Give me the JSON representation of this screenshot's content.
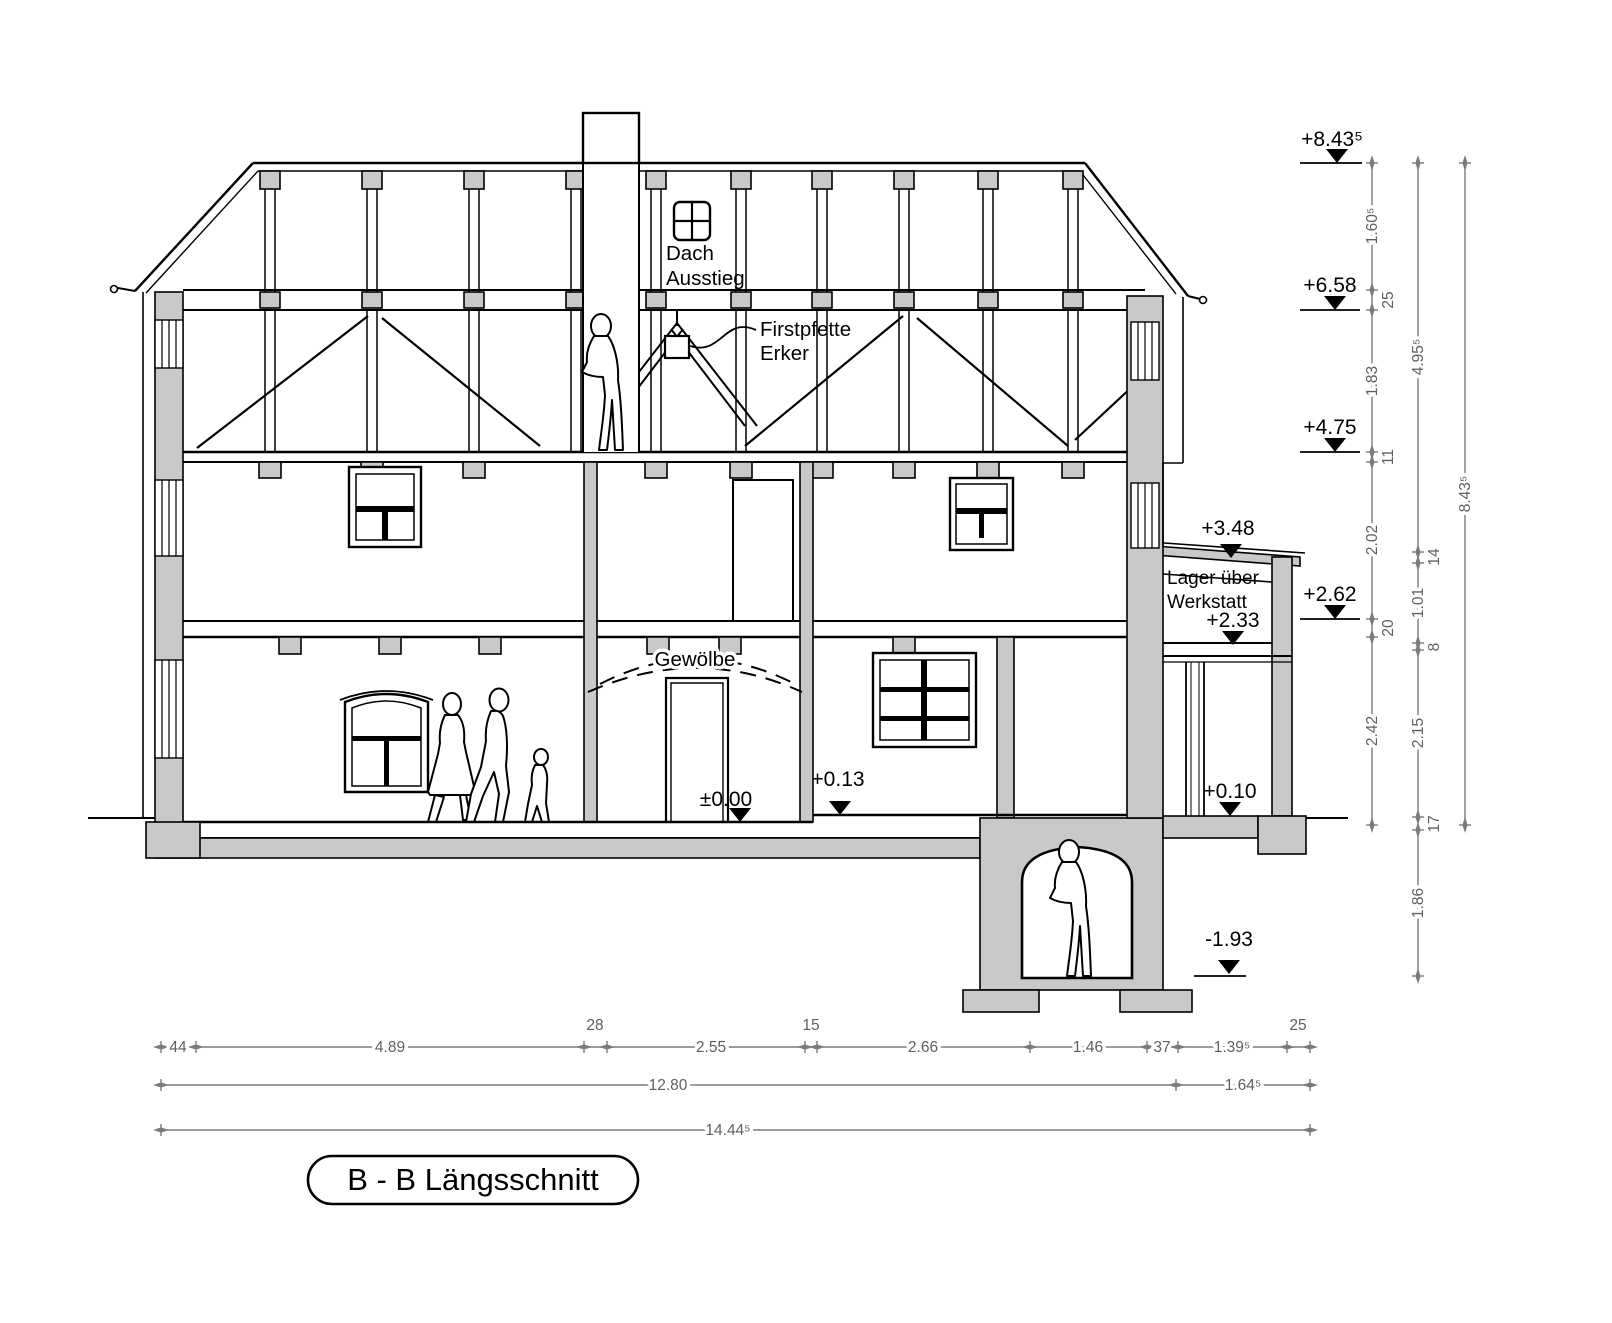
{
  "title": "B - B Längsschnitt",
  "annotations": {
    "dach_ausstieg": [
      "Dach",
      "Ausstieg"
    ],
    "firstpfette": [
      "Firstpfette",
      "Erker"
    ],
    "gewoelbe": "Gewölbe",
    "lager": [
      "Lager über",
      "Werkstatt"
    ]
  },
  "elevations": {
    "roof_ridge": "+8.43⁵",
    "eaves": "+6.58",
    "attic_floor": "+4.75",
    "annex_roof": "+3.48",
    "first_floor": "+2.62",
    "storage_floor": "+2.33",
    "ground_floor": "±0.00",
    "ground_outside": "+0.13",
    "workshop_floor": "+0.10",
    "basement_floor": "-1.93"
  },
  "dimensions": {
    "col_inner": [
      "1.60⁵",
      "25",
      "1.83",
      "11",
      "2.02",
      "20",
      "2.42"
    ],
    "col_middle": [
      "4.95⁵",
      "14",
      "1.01",
      "8",
      "2.15",
      "17",
      "1.86"
    ],
    "col_outer": [
      "8.43⁵"
    ],
    "row_top": [
      "44",
      "4.89",
      "28",
      "2.55",
      "15",
      "2.66",
      "1.46",
      "37",
      "1.39⁵",
      "25"
    ],
    "row_mid": [
      "12.80",
      "1.64⁵"
    ],
    "row_bottom": [
      "14.44⁵"
    ]
  },
  "colors": {
    "masonry_fill": "#c9c9c9",
    "line": "#000000",
    "dimension": "#7b7b7b"
  }
}
